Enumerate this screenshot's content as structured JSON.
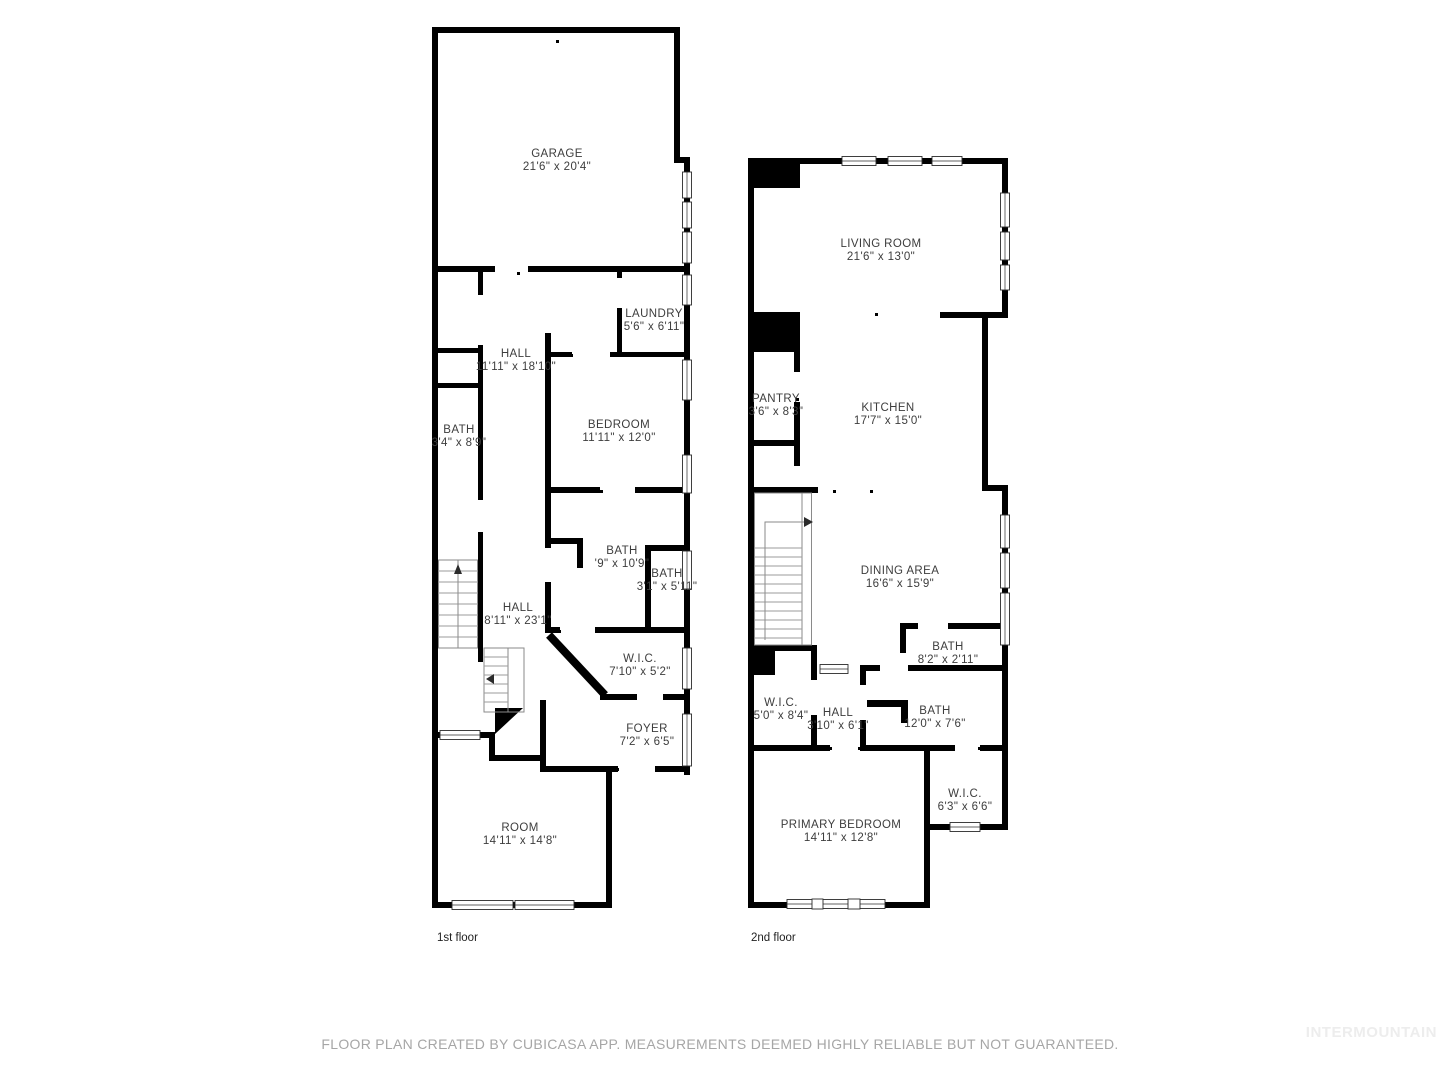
{
  "floors": [
    {
      "label": "1st floor",
      "rooms": [
        {
          "name": "GARAGE",
          "dims": "21'6\" x 20'4\""
        },
        {
          "name": "HALL",
          "dims": "11'11\" x 18'10\""
        },
        {
          "name": "LAUNDRY",
          "dims": "5'6\" x 6'11\""
        },
        {
          "name": "BATH",
          "dims": "3'4\" x 8'9\""
        },
        {
          "name": "BEDROOM",
          "dims": "11'11\" x 12'0\""
        },
        {
          "name": "BATH",
          "dims": "'9\" x 10'9\""
        },
        {
          "name": "BATH",
          "dims": "3'1\" x 5'11\""
        },
        {
          "name": "HALL",
          "dims": "8'11\" x 23'1\""
        },
        {
          "name": "W.I.C.",
          "dims": "7'10\" x 5'2\""
        },
        {
          "name": "FOYER",
          "dims": "7'2\" x 6'5\""
        },
        {
          "name": "ROOM",
          "dims": "14'11\" x 14'8\""
        }
      ]
    },
    {
      "label": "2nd floor",
      "rooms": [
        {
          "name": "LIVING ROOM",
          "dims": "21'6\" x 13'0\""
        },
        {
          "name": "PANTRY",
          "dims": "3'6\" x 8'3\""
        },
        {
          "name": "KITCHEN",
          "dims": "17'7\" x 15'0\""
        },
        {
          "name": "DINING AREA",
          "dims": "16'6\" x 15'9\""
        },
        {
          "name": "BATH",
          "dims": "8'2\" x 2'11\""
        },
        {
          "name": "W.I.C.",
          "dims": "5'0\" x 8'4\""
        },
        {
          "name": "HALL",
          "dims": "3'10\" x 6'1\""
        },
        {
          "name": "BATH",
          "dims": "12'0\" x 7'6\""
        },
        {
          "name": "W.I.C.",
          "dims": "6'3\" x 6'6\""
        },
        {
          "name": "PRIMARY BEDROOM",
          "dims": "14'11\" x 12'8\""
        }
      ]
    }
  ],
  "footer": {
    "disclaimer": "FLOOR PLAN CREATED BY CUBICASA APP. MEASUREMENTS DEEMED HIGHLY RELIABLE BUT NOT GUARANTEED.",
    "watermark": "INTERMOUNTAIN"
  },
  "colors": {
    "wall": "#000000",
    "label_text": "#3d3d3d",
    "floor_label": "#222222",
    "disclaimer": "#a6a6a6",
    "watermark": "#ededed",
    "background": "#ffffff"
  }
}
